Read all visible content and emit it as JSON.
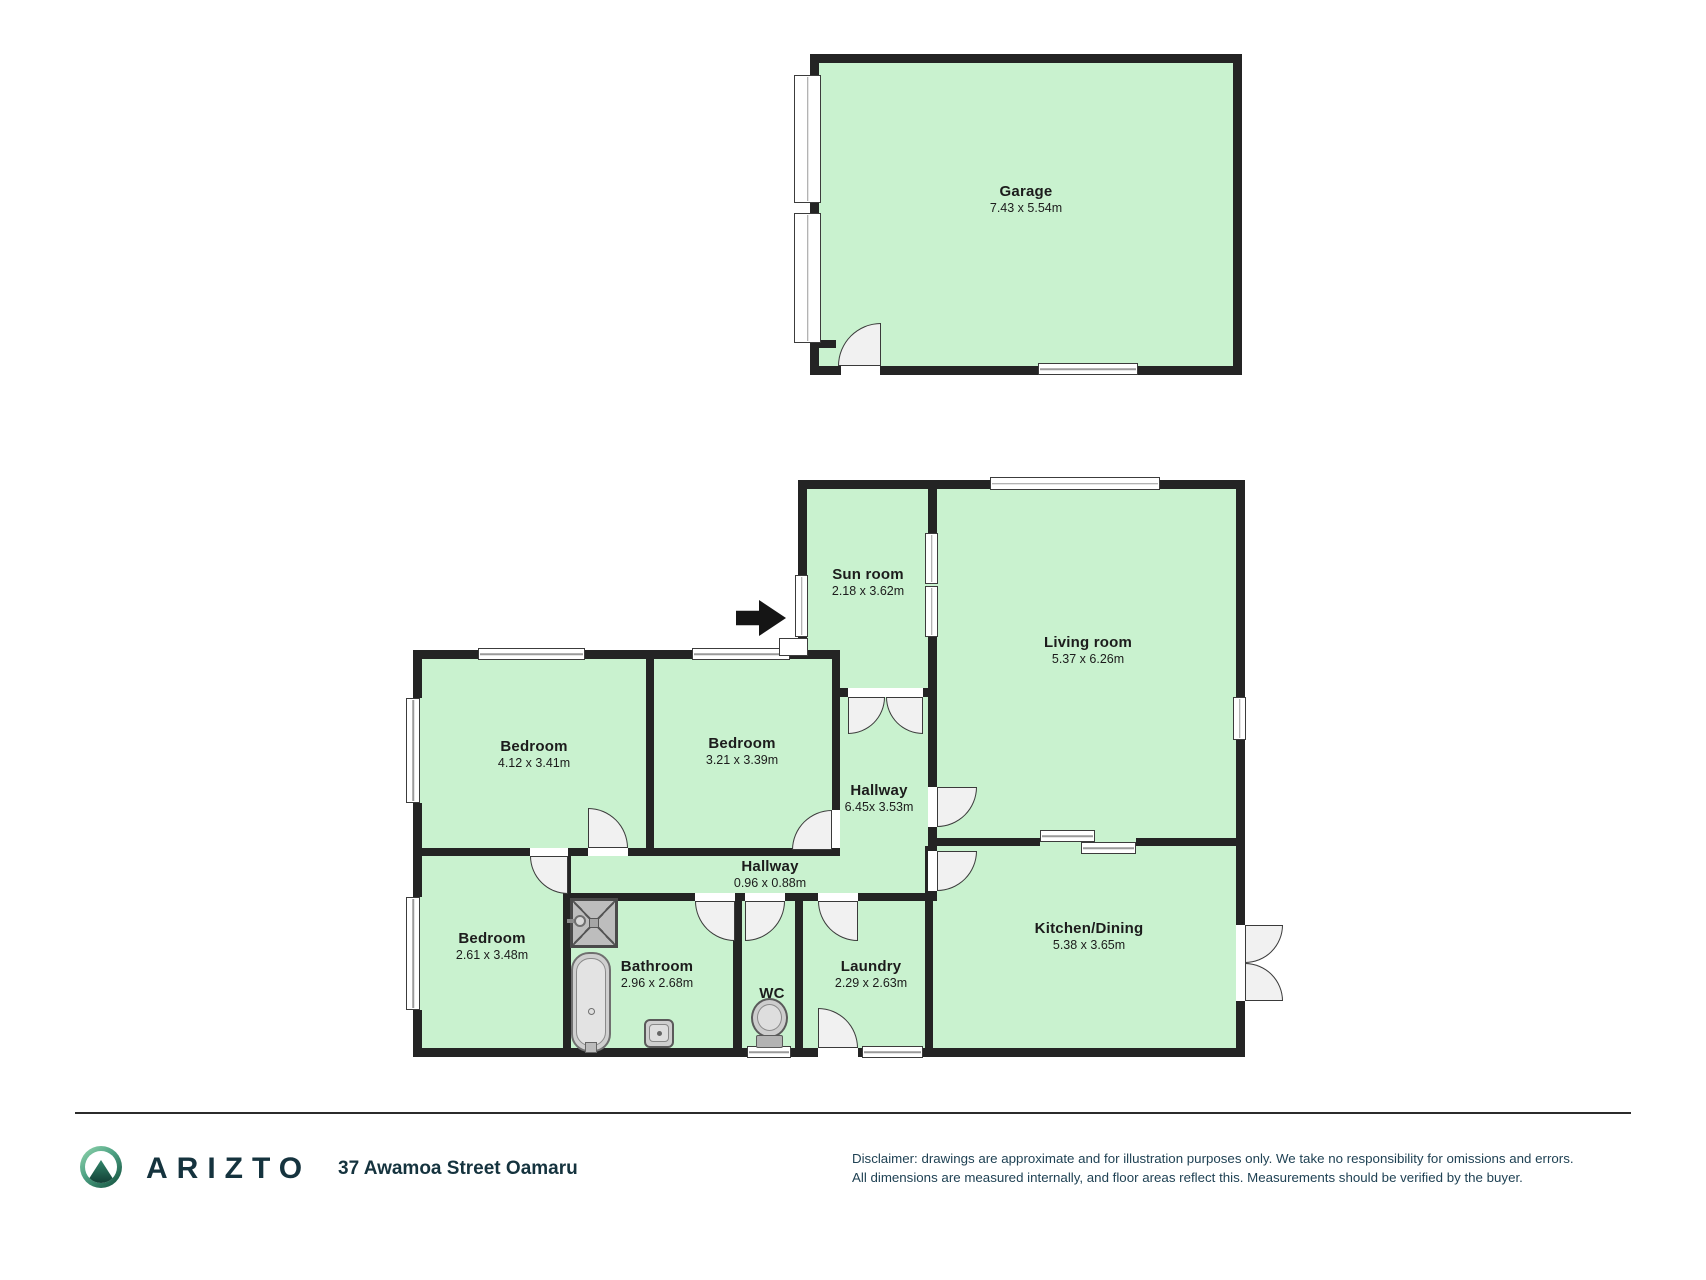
{
  "colors": {
    "room_fill": "#c9f2cf",
    "wall": "#242424",
    "door_fill": "#f1f1f1",
    "brand_navy": "#15333e",
    "logo_green_light": "#8ed3ab",
    "logo_green_dark": "#14523f"
  },
  "rooms": {
    "garage": {
      "name": "Garage",
      "dims": "7.43 x 5.54m"
    },
    "sunroom": {
      "name": "Sun room",
      "dims": "2.18 x 3.62m"
    },
    "living": {
      "name": "Living room",
      "dims": "5.37 x 6.26m"
    },
    "bedroom1": {
      "name": "Bedroom",
      "dims": "4.12 x 3.41m"
    },
    "bedroom2": {
      "name": "Bedroom",
      "dims": "3.21 x 3.39m"
    },
    "hallway_main": {
      "name": "Hallway",
      "dims": "6.45x 3.53m"
    },
    "hallway_small": {
      "name": "Hallway",
      "dims": "0.96 x 0.88m"
    },
    "bedroom3": {
      "name": "Bedroom",
      "dims": "2.61 x 3.48m"
    },
    "bathroom": {
      "name": "Bathroom",
      "dims": "2.96 x 2.68m"
    },
    "wc": {
      "name": "WC"
    },
    "laundry": {
      "name": "Laundry",
      "dims": "2.29 x 2.63m"
    },
    "kitchen": {
      "name": "Kitchen/Dining",
      "dims": "5.38 x 3.65m"
    }
  },
  "footer": {
    "brand": "ARIZTO",
    "address": "37 Awamoa Street Oamaru",
    "disclaimer_line1": "Disclaimer: drawings are approximate and for illustration purposes only. We take no responsibility for omissions and errors.",
    "disclaimer_line2": "All dimensions are measured internally, and floor areas reflect this. Measurements should be verified by the buyer."
  }
}
